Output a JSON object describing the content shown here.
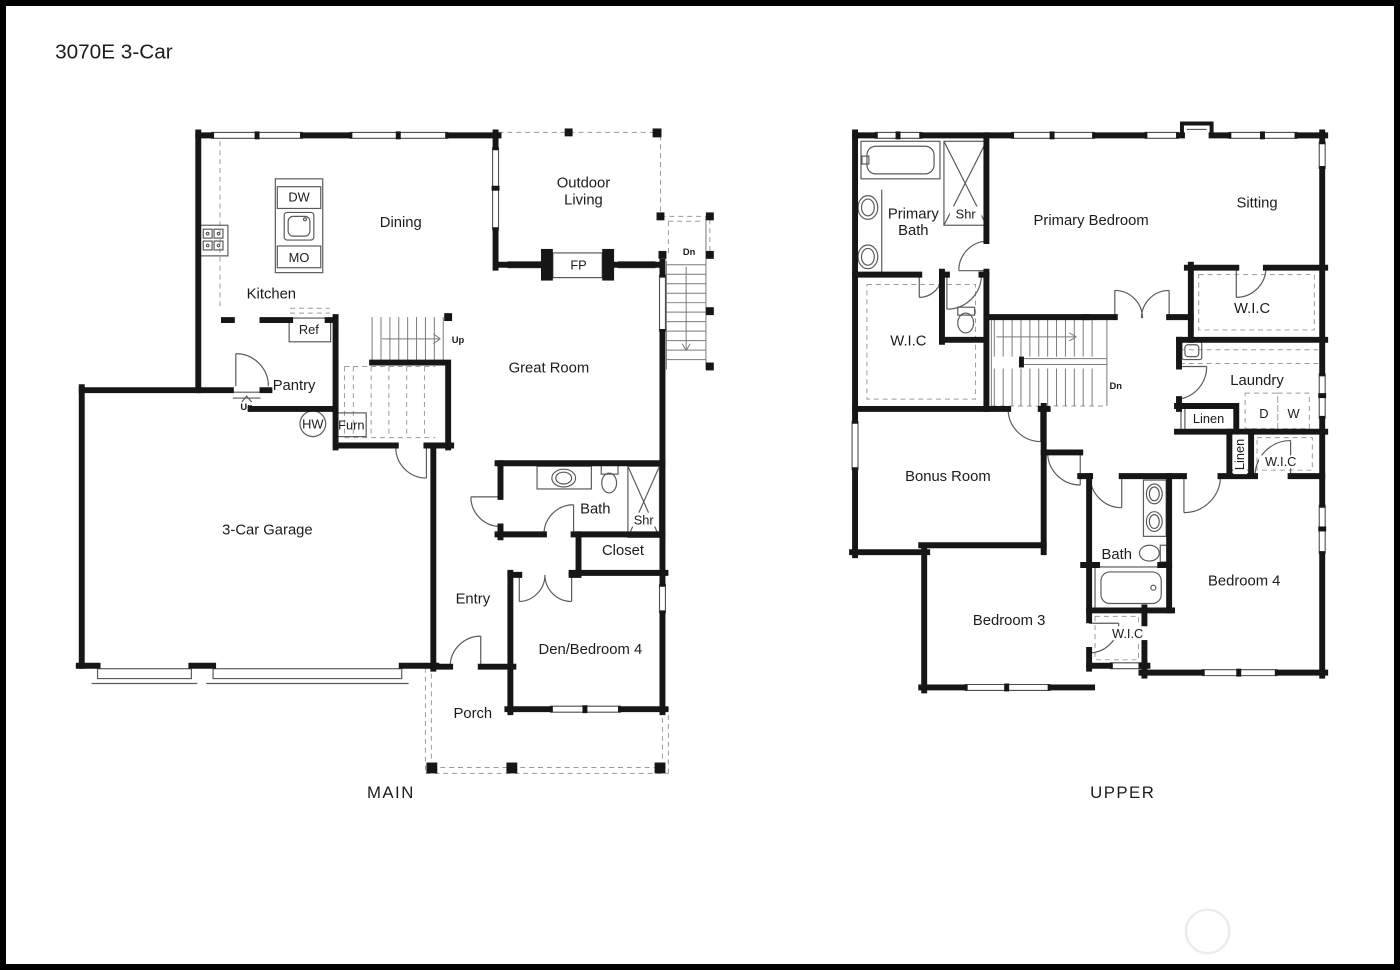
{
  "title": "3070E 3-Car",
  "main": {
    "caption": "MAIN",
    "rooms": {
      "dining": "Dining",
      "kitchen": "Kitchen",
      "outdoor_line1": "Outdoor",
      "outdoor_line2": "Living",
      "great_room": "Great Room",
      "pantry": "Pantry",
      "garage": "3-Car Garage",
      "bath": "Bath",
      "closet": "Closet",
      "entry": "Entry",
      "den": "Den/Bedroom 4",
      "porch": "Porch"
    },
    "fixtures": {
      "dw": "DW",
      "mo": "MO",
      "ref": "Ref",
      "fp": "FP",
      "hw": "HW",
      "furn": "Furn",
      "shr": "Shr"
    },
    "stairs": {
      "up_main": "Up",
      "up_entry": "Up",
      "dn_exterior": "Dn"
    }
  },
  "upper": {
    "caption": "UPPER",
    "rooms": {
      "primary_bath_line1": "Primary",
      "primary_bath_line2": "Bath",
      "primary_bedroom": "Primary Bedroom",
      "sitting": "Sitting",
      "wic_primary": "W.I.C",
      "wic_sitting": "W.I.C",
      "laundry": "Laundry",
      "bonus": "Bonus Room",
      "bath": "Bath",
      "bedroom3": "Bedroom 3",
      "bedroom4": "Bedroom 4",
      "wic_bedroom3": "W.I.C",
      "wic_bedroom4": "W.I.C"
    },
    "fixtures": {
      "shr": "Shr",
      "dryer": "D",
      "washer": "W",
      "linen_hall": "Linen",
      "linen_closet": "Linen"
    },
    "stairs": {
      "dn": "Dn"
    }
  }
}
